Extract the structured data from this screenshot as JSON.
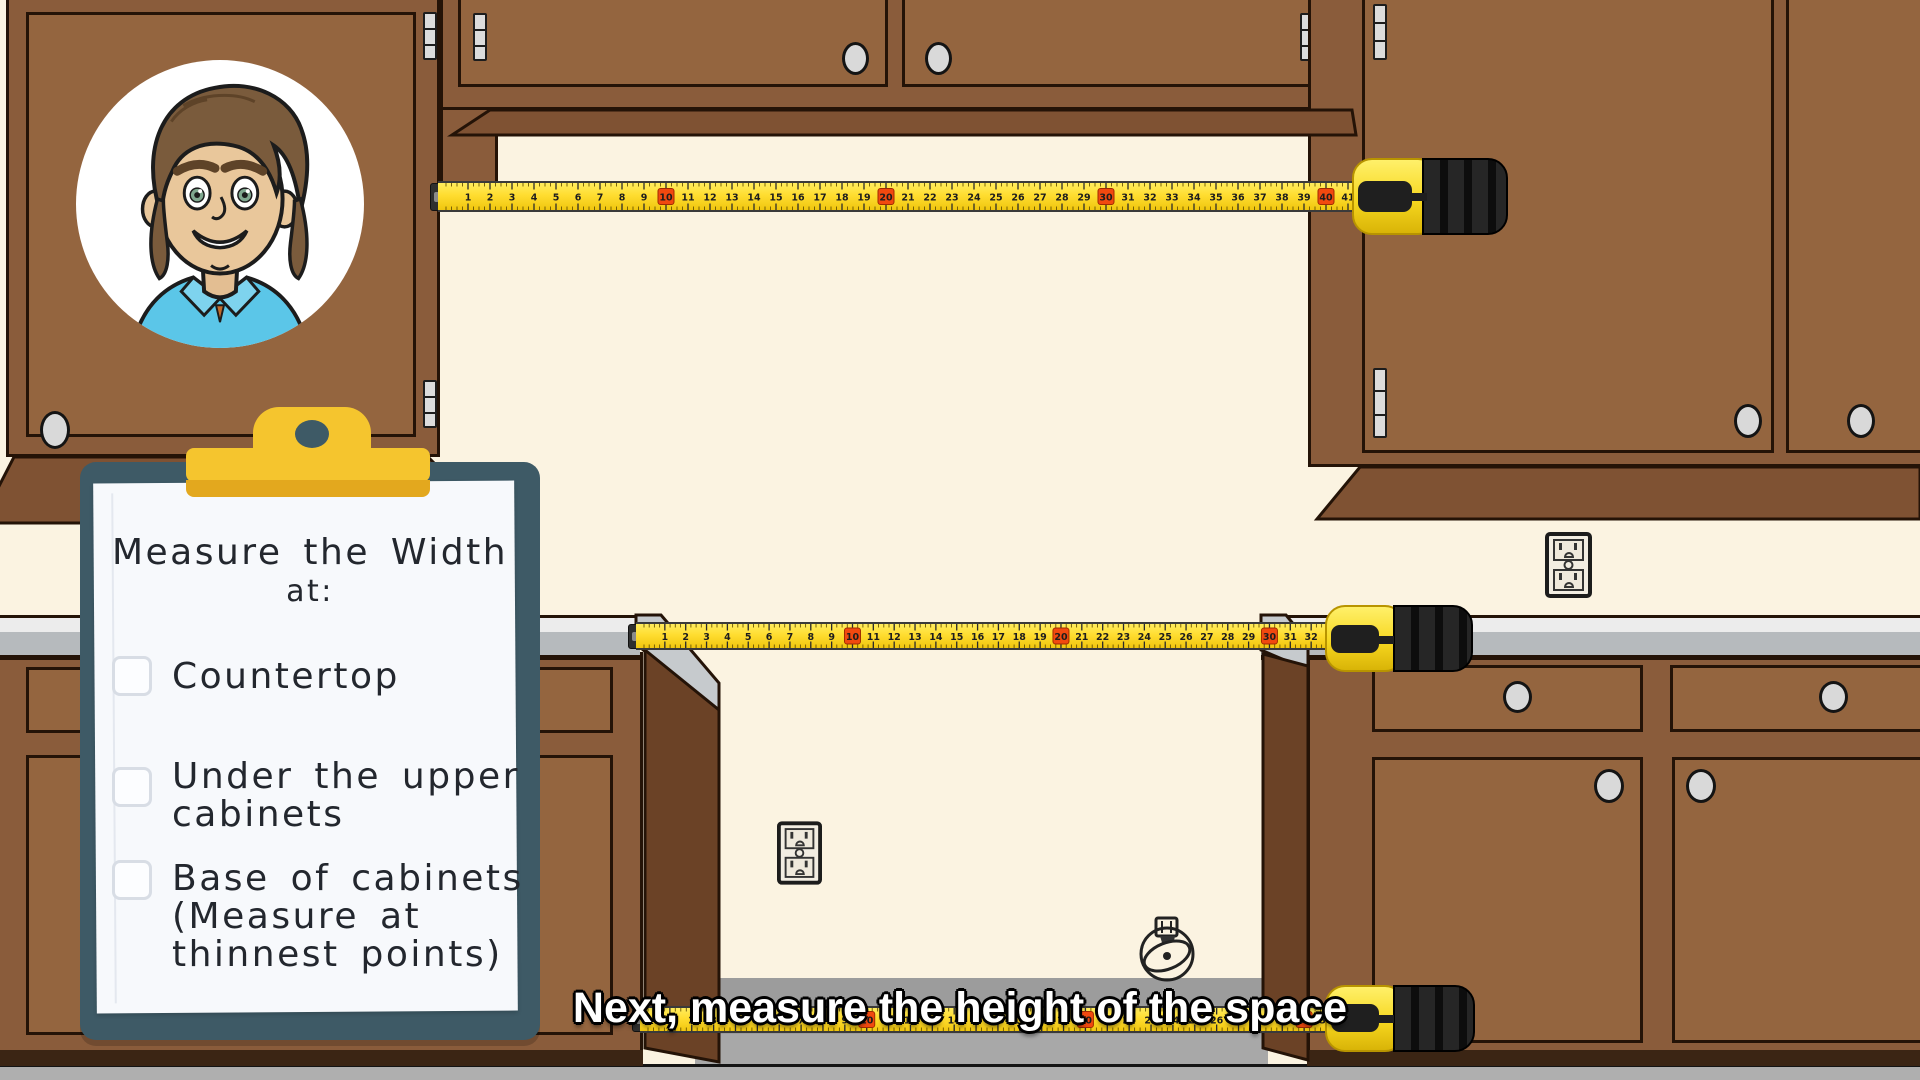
{
  "caption": {
    "text": "Next, measure the height of the space"
  },
  "clipboard": {
    "heading": [
      "Measure the Width",
      "at:"
    ],
    "items": [
      {
        "label": "Countertop",
        "lines": [
          "Countertop"
        ],
        "checked": false
      },
      {
        "label": "Under the upper cabinets",
        "lines": [
          "Under the upper",
          "cabinets"
        ],
        "checked": false
      },
      {
        "label": "Base of cabinets (Measure at thinnest points)",
        "lines": [
          "Base of cabinets",
          "(Measure at",
          "thinnest points)"
        ],
        "checked": false
      }
    ]
  },
  "tape_measures": [
    {
      "name": "upper-cabinet-width-tape",
      "max_value": 41
    },
    {
      "name": "countertop-width-tape",
      "max_value": 33
    },
    {
      "name": "cabinet-base-width-tape",
      "max_value": 31
    }
  ],
  "tape_marker_interval": 10,
  "colors": {
    "wall_cream": "#FBF3E1",
    "floor_gray": "#ACACAC",
    "cabinet_brown": "#8A5C3B",
    "cabinet_door_brown": "#94653F",
    "cabinet_outline": "#241307",
    "molding_brown": "#7F5233",
    "counter_gray": "#B6BABD",
    "clipboard_teal": "#3E5A66",
    "clip_yellow": "#F5C52E",
    "paper_white": "#F7F9FC",
    "tape_yellow": "#FFDD30",
    "tape_marker_red": "#F1490F",
    "caption_text": "#FFFFFF",
    "shirt_blue": "#5BC6E8"
  }
}
